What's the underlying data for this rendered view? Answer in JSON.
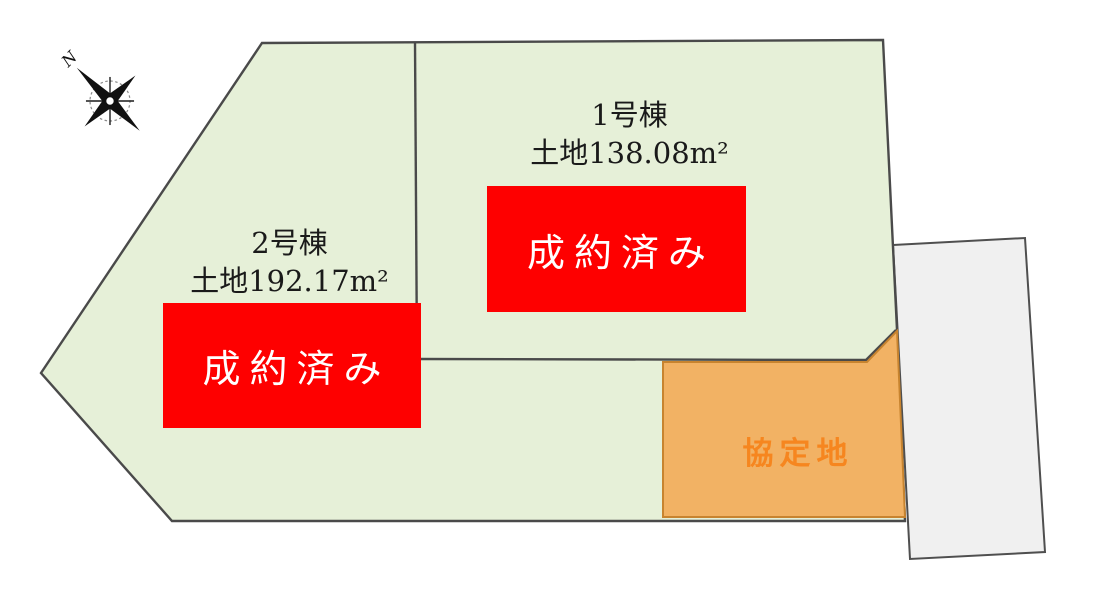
{
  "page": {
    "title": "区画図"
  },
  "compass": {
    "label": "N"
  },
  "lots": [
    {
      "id": "lot-1",
      "name": "1号棟",
      "area_label": "土地138.08m²",
      "status": "成約済み"
    },
    {
      "id": "lot-2",
      "name": "2号棟",
      "area_label": "土地192.17m²",
      "status": "成約済み"
    }
  ],
  "agreement_area": {
    "label": "協定地"
  },
  "colors": {
    "lot_fill": "#E6F0D8",
    "lot_border": "#4A4A4A",
    "sold_banner": "#FE0000",
    "sold_text": "#FFFFFF",
    "agreement_fill": "#F2B264",
    "agreement_border": "#C8842F",
    "agreement_text": "#F6861F",
    "neighbor_fill": "#F0F0F0",
    "neighbor_border": "#4F4F4F",
    "label_text": "#1A1A1A"
  }
}
